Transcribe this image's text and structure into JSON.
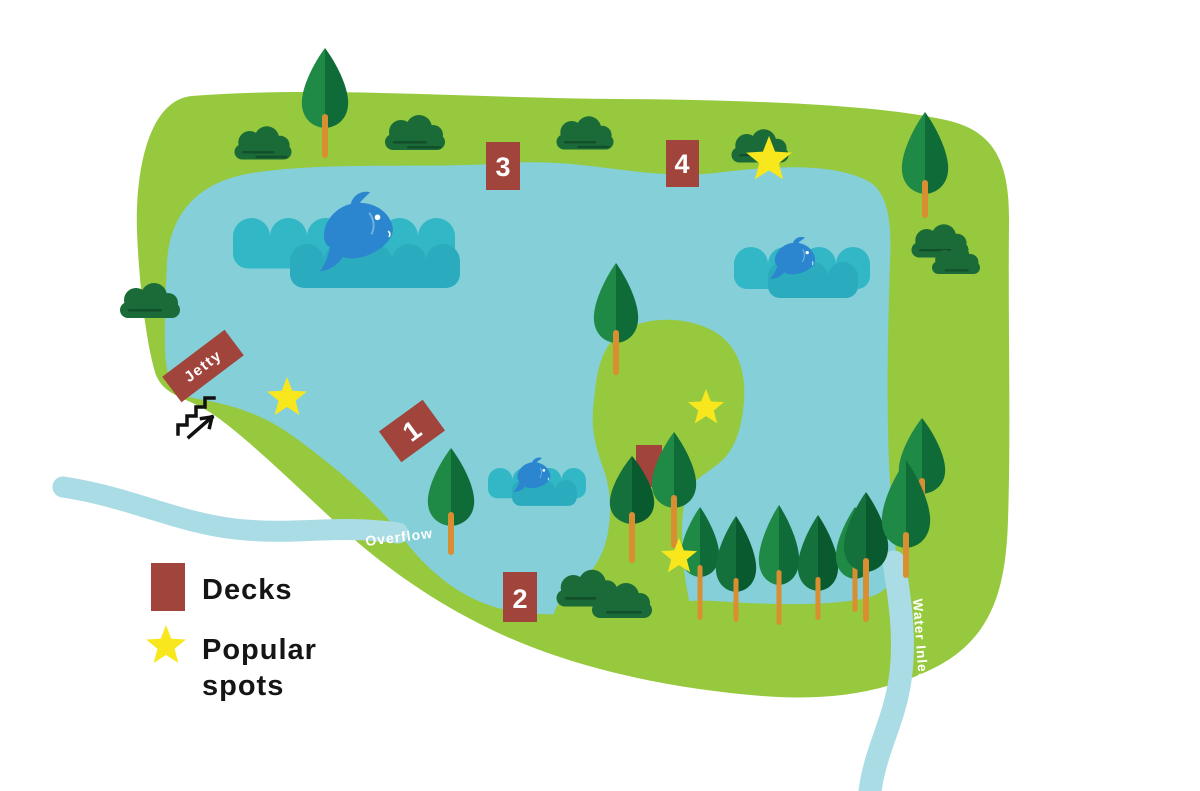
{
  "map": {
    "jetty_label": "Jetty",
    "overflow_label": "Overflow",
    "water_inlet_label": "Water Inlet",
    "decks": [
      {
        "id": "deck-1",
        "label": "1"
      },
      {
        "id": "deck-2",
        "label": "2"
      },
      {
        "id": "deck-3",
        "label": "3"
      },
      {
        "id": "deck-4",
        "label": "4"
      }
    ],
    "popular_spot_count": 4
  },
  "legend": {
    "decks_label": "Decks",
    "popular_spots_line1": "Popular",
    "popular_spots_line2": "spots"
  },
  "colors": {
    "land": "#96C93D",
    "lake": "#84CFD8",
    "stream": "#A9DCE4",
    "wave": "#31B7C6",
    "wave_dark": "#2AABBE",
    "fish": "#2B85CF",
    "deck": "#A0443C",
    "trunk": "#D98E32",
    "star": "#F8E71C",
    "bush": "#1B6B38",
    "tree_light": "#1F8A46",
    "tree_dark": "#0F6B38",
    "legend_text": "#151515",
    "label_text": "#FFFFFF"
  }
}
